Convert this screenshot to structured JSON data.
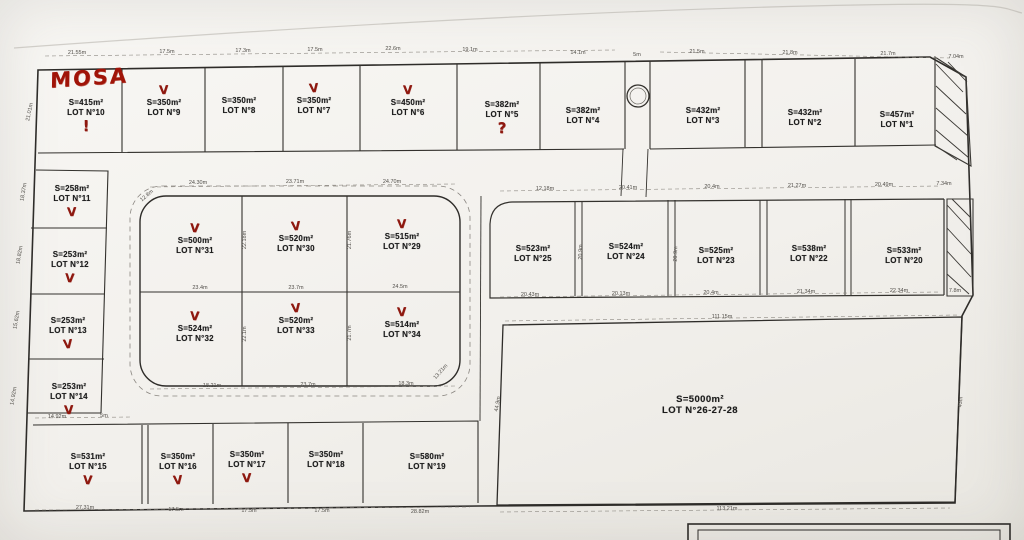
{
  "annotations": {
    "mosa": "MOSA",
    "check_glyph": "V",
    "exclamation": "!",
    "question": "?"
  },
  "lots": [
    {
      "area": "S=415m²",
      "lot": "LOT N°10"
    },
    {
      "area": "S=350m²",
      "lot": "LOT N°9"
    },
    {
      "area": "S=350m²",
      "lot": "LOT N°8"
    },
    {
      "area": "S=350m²",
      "lot": "LOT N°7"
    },
    {
      "area": "S=450m²",
      "lot": "LOT N°6"
    },
    {
      "area": "S=382m²",
      "lot": "LOT N°5"
    },
    {
      "area": "S=382m²",
      "lot": "LOT N°4"
    },
    {
      "area": "S=432m²",
      "lot": "LOT N°3"
    },
    {
      "area": "S=432m²",
      "lot": "LOT N°2"
    },
    {
      "area": "S=457m²",
      "lot": "LOT N°1"
    },
    {
      "area": "S=258m²",
      "lot": "LOT N°11"
    },
    {
      "area": "S=253m²",
      "lot": "LOT N°12"
    },
    {
      "area": "S=253m²",
      "lot": "LOT N°13"
    },
    {
      "area": "S=253m²",
      "lot": "LOT N°14"
    },
    {
      "area": "S=500m²",
      "lot": "LOT N°31"
    },
    {
      "area": "S=520m²",
      "lot": "LOT N°30"
    },
    {
      "area": "S=515m²",
      "lot": "LOT N°29"
    },
    {
      "area": "S=524m²",
      "lot": "LOT N°32"
    },
    {
      "area": "S=520m²",
      "lot": "LOT N°33"
    },
    {
      "area": "S=514m²",
      "lot": "LOT N°34"
    },
    {
      "area": "S=523m²",
      "lot": "LOT N°25"
    },
    {
      "area": "S=524m²",
      "lot": "LOT N°24"
    },
    {
      "area": "S=525m²",
      "lot": "LOT N°23"
    },
    {
      "area": "S=538m²",
      "lot": "LOT N°22"
    },
    {
      "area": "S=533m²",
      "lot": "LOT N°20"
    },
    {
      "area": "S=5000m²",
      "lot": "LOT N°26-27-28"
    },
    {
      "area": "S=531m²",
      "lot": "LOT N°15"
    },
    {
      "area": "S=350m²",
      "lot": "LOT N°16"
    },
    {
      "area": "S=350m²",
      "lot": "LOT N°17"
    },
    {
      "area": "S=350m²",
      "lot": "LOT N°18"
    },
    {
      "area": "S=580m²",
      "lot": "LOT N°19"
    }
  ],
  "dim_labels": [
    "21.55m",
    "17.5m",
    "17.3m",
    "17.5m",
    "22.6m",
    "19.1m",
    "14.1m",
    "5m",
    "21.5m",
    "21.8m",
    "21.7m",
    "7.04m",
    "24.30m",
    "23.71m",
    "24.70m",
    "12.18m",
    "20.41m",
    "20.4m",
    "21.27m",
    "20.49m",
    "7.34m",
    "23.4m",
    "23.7m",
    "24.5m",
    "18.21m",
    "23.7m",
    "18.3m",
    "13.21m",
    "12.8m",
    "20.43m",
    "20.13m",
    "20.4m",
    "21.34m",
    "22.34m",
    "7.8m",
    "111.15m",
    "113.21m",
    "44.9m",
    "43m",
    "27.31m",
    "17.5m",
    "17.5m",
    "17.5m",
    "28.82m",
    "21.01m",
    "18.37m",
    "18.82m",
    "15.62m",
    "14.92m",
    "14.92m",
    "5m",
    "22.18m",
    "21.76m",
    "22.1m",
    "21.7m",
    "20.9m",
    "20.9m"
  ]
}
